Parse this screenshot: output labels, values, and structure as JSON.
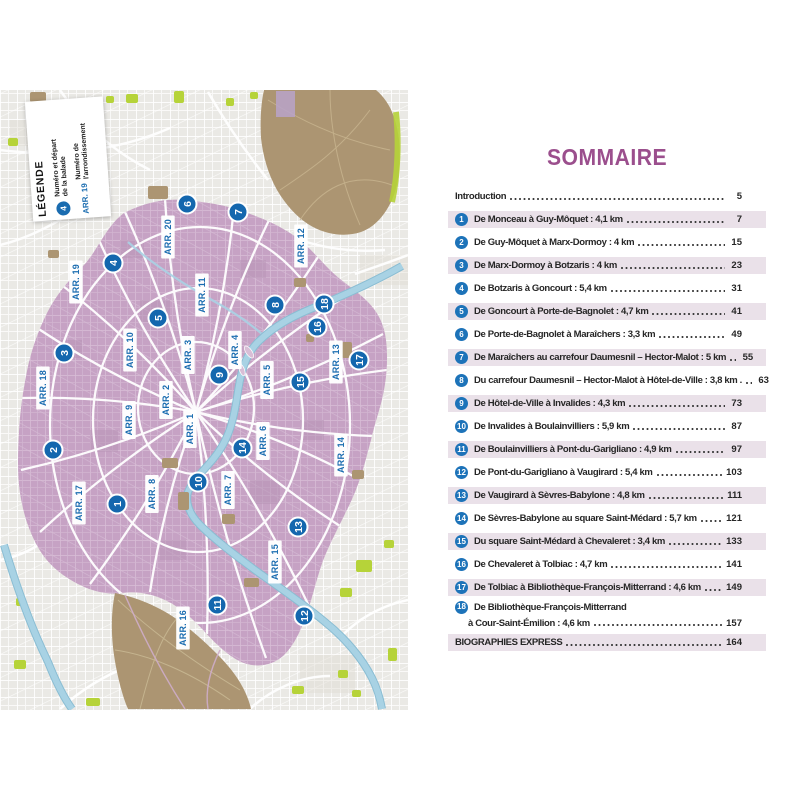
{
  "legend": {
    "title": "LÉGENDE",
    "marker_example": "4",
    "marker_label_line1": "Numéro et départ",
    "marker_label_line2": "de la balade",
    "arr_example": "ARR. 19",
    "arr_label_line1": "Numéro de",
    "arr_label_line2": "l'arrondissement"
  },
  "map": {
    "colors": {
      "city_purple": "#c6a2c4",
      "outskirts_gray": "#eae9e5",
      "park_brown": "#ac9572",
      "green": "#b6d339",
      "river_blue": "#a8d2e4",
      "marker_blue": "#1467ae",
      "label_blue": "#1a6cb0"
    },
    "arr_labels": [
      {
        "label": "ARR. 20",
        "x": 168,
        "y": 237
      },
      {
        "label": "ARR. 19",
        "x": 76,
        "y": 282
      },
      {
        "label": "ARR. 12",
        "x": 301,
        "y": 246
      },
      {
        "label": "ARR. 11",
        "x": 202,
        "y": 295
      },
      {
        "label": "ARR. 10",
        "x": 130,
        "y": 350
      },
      {
        "label": "ARR. 3",
        "x": 188,
        "y": 355
      },
      {
        "label": "ARR. 4",
        "x": 235,
        "y": 350
      },
      {
        "label": "ARR. 13",
        "x": 336,
        "y": 362
      },
      {
        "label": "ARR. 18",
        "x": 43,
        "y": 388
      },
      {
        "label": "ARR. 5",
        "x": 267,
        "y": 380
      },
      {
        "label": "ARR. 2",
        "x": 166,
        "y": 400
      },
      {
        "label": "ARR. 9",
        "x": 129,
        "y": 420
      },
      {
        "label": "ARR. 1",
        "x": 190,
        "y": 429
      },
      {
        "label": "ARR. 6",
        "x": 263,
        "y": 441
      },
      {
        "label": "ARR. 14",
        "x": 341,
        "y": 455
      },
      {
        "label": "ARR. 17",
        "x": 79,
        "y": 503
      },
      {
        "label": "ARR. 8",
        "x": 152,
        "y": 494
      },
      {
        "label": "ARR. 7",
        "x": 228,
        "y": 490
      },
      {
        "label": "ARR. 15",
        "x": 275,
        "y": 562
      },
      {
        "label": "ARR. 16",
        "x": 183,
        "y": 628
      }
    ],
    "route_markers": [
      {
        "n": "1",
        "x": 117,
        "y": 504
      },
      {
        "n": "2",
        "x": 53,
        "y": 450
      },
      {
        "n": "3",
        "x": 64,
        "y": 353
      },
      {
        "n": "4",
        "x": 113,
        "y": 263
      },
      {
        "n": "5",
        "x": 158,
        "y": 318
      },
      {
        "n": "6",
        "x": 187,
        "y": 204
      },
      {
        "n": "7",
        "x": 238,
        "y": 212
      },
      {
        "n": "8",
        "x": 275,
        "y": 305
      },
      {
        "n": "9",
        "x": 219,
        "y": 375
      },
      {
        "n": "10",
        "x": 198,
        "y": 482
      },
      {
        "n": "11",
        "x": 217,
        "y": 605
      },
      {
        "n": "12",
        "x": 304,
        "y": 616
      },
      {
        "n": "13",
        "x": 298,
        "y": 527
      },
      {
        "n": "14",
        "x": 242,
        "y": 448
      },
      {
        "n": "15",
        "x": 300,
        "y": 382
      },
      {
        "n": "16",
        "x": 317,
        "y": 327
      },
      {
        "n": "17",
        "x": 359,
        "y": 360
      },
      {
        "n": "18",
        "x": 324,
        "y": 304
      }
    ]
  },
  "toc": {
    "title": "SOMMAIRE",
    "rows": [
      {
        "type": "plain",
        "text": "Introduction",
        "page": "5",
        "shaded": false
      },
      {
        "type": "num",
        "num": "1",
        "text": "De Monceau à Guy-Môquet : 4,1 km",
        "page": "7",
        "shaded": true
      },
      {
        "type": "num",
        "num": "2",
        "text": "De Guy-Môquet à Marx-Dormoy : 4 km",
        "page": "15",
        "shaded": false
      },
      {
        "type": "num",
        "num": "3",
        "text": "De Marx-Dormoy à Botzaris : 4 km",
        "page": "23",
        "shaded": true
      },
      {
        "type": "num",
        "num": "4",
        "text": "De Botzaris à Goncourt : 5,4 km",
        "page": "31",
        "shaded": false
      },
      {
        "type": "num",
        "num": "5",
        "text": "De Goncourt à Porte-de-Bagnolet : 4,7 km",
        "page": "41",
        "shaded": true
      },
      {
        "type": "num",
        "num": "6",
        "text": "De Porte-de-Bagnolet à Maraîchers : 3,3 km",
        "page": "49",
        "shaded": false
      },
      {
        "type": "num",
        "num": "7",
        "text": "De Maraîchers au carrefour Daumesnil – Hector-Malot : 5 km",
        "page": "55",
        "shaded": true
      },
      {
        "type": "num",
        "num": "8",
        "text": "Du carrefour Daumesnil – Hector-Malot à Hôtel-de-Ville : 3,8 km .",
        "page": "63",
        "shaded": false
      },
      {
        "type": "num",
        "num": "9",
        "text": "De Hôtel-de-Ville à Invalides : 4,3 km",
        "page": "73",
        "shaded": true
      },
      {
        "type": "num",
        "num": "10",
        "text": "De Invalides à Boulainvilliers : 5,9 km",
        "page": "87",
        "shaded": false
      },
      {
        "type": "num",
        "num": "11",
        "text": "De Boulainvilliers à Pont-du-Garigliano : 4,9 km",
        "page": "97",
        "shaded": true
      },
      {
        "type": "num",
        "num": "12",
        "text": "De Pont-du-Garigliano à Vaugirard : 5,4 km",
        "page": "103",
        "shaded": false
      },
      {
        "type": "num",
        "num": "13",
        "text": "De Vaugirard à Sèvres-Babylone : 4,8 km",
        "page": "111",
        "shaded": true
      },
      {
        "type": "num",
        "num": "14",
        "text": "De Sèvres-Babylone au square Saint-Médard : 5,7 km",
        "page": "121",
        "shaded": false
      },
      {
        "type": "num",
        "num": "15",
        "text": "Du square Saint-Médard à Chevaleret : 3,4 km",
        "page": "133",
        "shaded": true
      },
      {
        "type": "num",
        "num": "16",
        "text": "De Chevaleret à Tolbiac : 4,7 km",
        "page": "141",
        "shaded": false
      },
      {
        "type": "num",
        "num": "17",
        "text": "De Tolbiac à Bibliothèque-François-Mitterrand : 4,6 km",
        "page": "149",
        "shaded": true
      },
      {
        "type": "num2",
        "num": "18",
        "text": "De Bibliothèque-François-Mitterrand",
        "text2": "à Cour-Saint-Émilion : 4,6 km",
        "page": "157",
        "shaded": false
      },
      {
        "type": "plain",
        "text": "BIOGRAPHIES EXPRESS",
        "page": "164",
        "shaded": true
      }
    ]
  }
}
